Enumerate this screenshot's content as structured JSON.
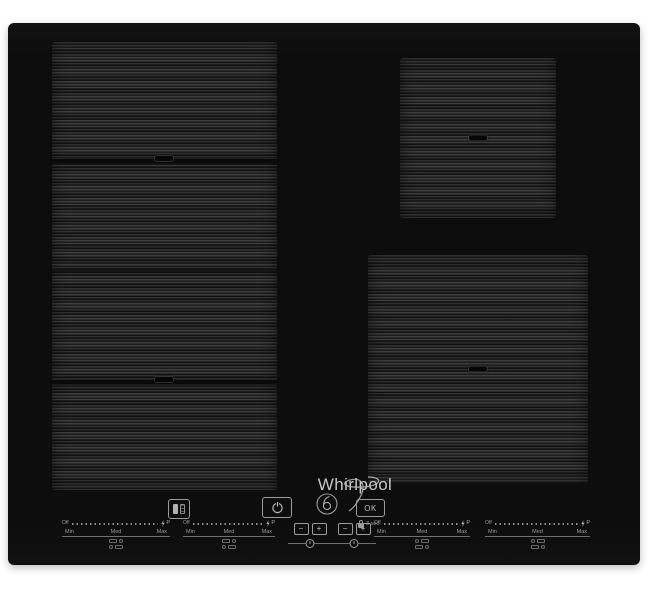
{
  "brand": {
    "logo_text": "Whirlpool",
    "logo_swirl_icon": "whirlpool-swirl-icon"
  },
  "colors": {
    "background": "#ffffff",
    "surface": "#0d0d0d",
    "zone_base": "#1d1d1d",
    "control_text": "#9a9a9a",
    "logo_text": "#c6c6c6"
  },
  "zones": [
    {
      "name": "flexi-zone-left",
      "sections": 4,
      "center_marks": 2
    },
    {
      "name": "zone-top-right",
      "center_marks": 1
    },
    {
      "name": "zone-bottom-right",
      "center_marks": 1
    }
  ],
  "controls": {
    "flexicook_button": {
      "icon": "flexicook-icon"
    },
    "power_button": {
      "icon": "power-icon"
    },
    "sixth_sense_button": {
      "icon": "sixth-sense-icon"
    },
    "ok_button": {
      "label": "OK"
    },
    "key_lock": {
      "icon": "lock-icon",
      "label": "3 sec"
    },
    "timer_minus_label": "−",
    "timer_plus_label": "+",
    "timer_icon": "clock-icon"
  },
  "sliders": [
    {
      "off": "Off",
      "min": "Min",
      "med": "Med",
      "max": "Max",
      "boost": "P",
      "boost_icon": "lightning-icon",
      "function_icons": [
        "special-function-icon",
        "special-function-icon"
      ]
    },
    {
      "off": "Off",
      "min": "Min",
      "med": "Med",
      "max": "Max",
      "boost": "P",
      "boost_icon": "lightning-icon",
      "function_icons": [
        "special-function-icon",
        "special-function-icon"
      ]
    },
    {
      "off": "Off",
      "min": "Min",
      "med": "Med",
      "max": "Max",
      "boost": "P",
      "boost_icon": "lightning-icon",
      "function_icons": [
        "special-function-icon",
        "special-function-icon"
      ]
    },
    {
      "off": "Off",
      "min": "Min",
      "med": "Med",
      "max": "Max",
      "boost": "P",
      "boost_icon": "lightning-icon",
      "function_icons": [
        "special-function-icon",
        "special-function-icon"
      ]
    }
  ]
}
